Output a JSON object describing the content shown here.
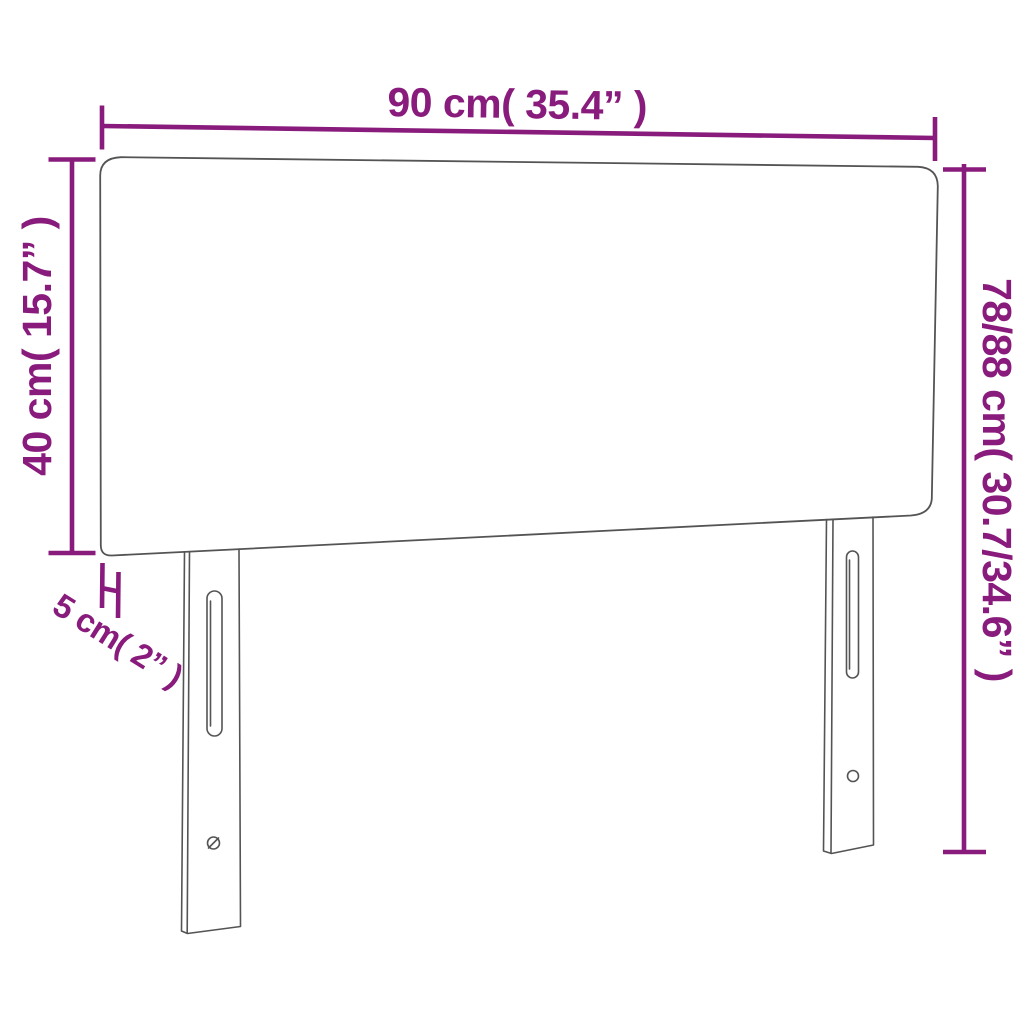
{
  "diagram": {
    "subject": "headboard-with-legs",
    "labels": {
      "width": "90 cm( 35.4” )",
      "left_height": "40 cm( 15.7” )",
      "right_height": "78/88 cm( 30.7/34.6” )",
      "thickness": "5 cm( 2” )"
    }
  },
  "colors": {
    "accent": "#881b7c",
    "outline": "#545454",
    "background": "#ffffff"
  }
}
